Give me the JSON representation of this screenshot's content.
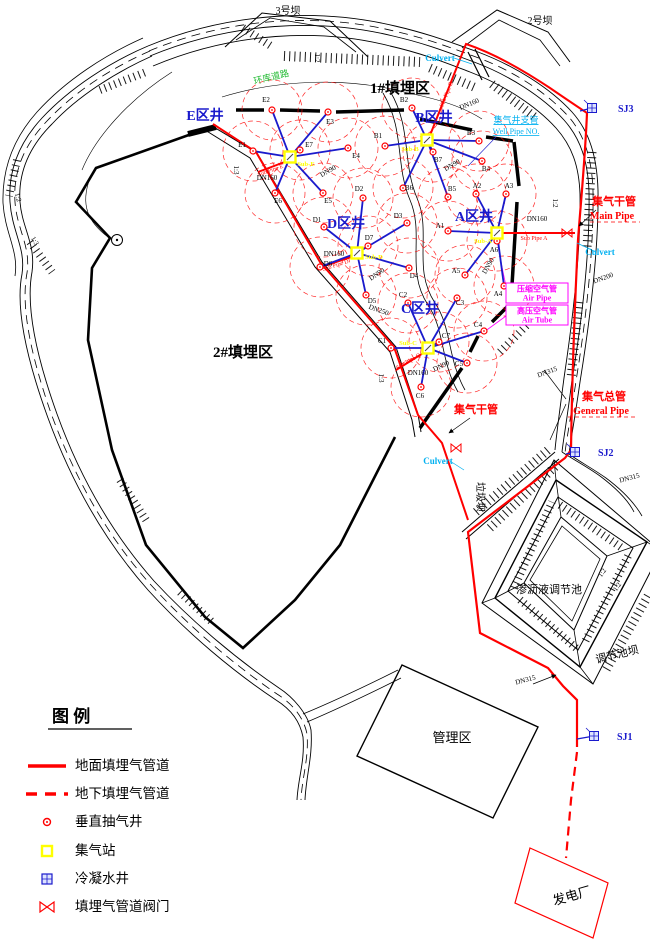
{
  "colors": {
    "pipe_red": "#ff0000",
    "spoke_blue": "#1a1acc",
    "cyan": "#00b0f0",
    "magenta": "#ff00ff",
    "yellow": "#ffff00",
    "green": "#22bb33",
    "black": "#000000"
  },
  "legend": {
    "title": "图   例",
    "items": [
      {
        "symbol": "solid-line",
        "label": "地面填埋气管道"
      },
      {
        "symbol": "dashed-line",
        "label": "地下填埋气管道"
      },
      {
        "symbol": "well-circle",
        "label": "垂直抽气井"
      },
      {
        "symbol": "station-square",
        "label": "集气站"
      },
      {
        "symbol": "condensate-square",
        "label": "冷凝水井"
      },
      {
        "symbol": "valve-bowtie",
        "label": "填埋气管道阀门"
      }
    ]
  },
  "clusters": [
    {
      "id": "E",
      "label": "E区井",
      "label_x": 205,
      "label_y": 120,
      "station_x": 290,
      "station_y": 157,
      "station_label": "Sub-E",
      "station_label_x": 306,
      "station_label_y": 166,
      "wells": [
        {
          "id": "E1",
          "x": 253,
          "y": 151,
          "lx": 242,
          "ly": 147
        },
        {
          "id": "E2",
          "x": 272,
          "y": 110,
          "lx": 266,
          "ly": 102
        },
        {
          "id": "E3",
          "x": 328,
          "y": 112,
          "lx": 330,
          "ly": 124
        },
        {
          "id": "E4",
          "x": 348,
          "y": 148,
          "lx": 356,
          "ly": 158
        },
        {
          "id": "E5",
          "x": 323,
          "y": 193,
          "lx": 328,
          "ly": 203
        },
        {
          "id": "E6",
          "x": 275,
          "y": 193,
          "lx": 278,
          "ly": 203
        },
        {
          "id": "E7",
          "x": 300,
          "y": 150,
          "lx": 309,
          "ly": 147
        }
      ]
    },
    {
      "id": "B",
      "label": "B区井",
      "label_x": 434,
      "label_y": 122,
      "station_x": 427,
      "station_y": 140,
      "station_label": "Sub-B",
      "station_label_x": 410,
      "station_label_y": 151,
      "wells": [
        {
          "id": "B1",
          "x": 385,
          "y": 146,
          "lx": 378,
          "ly": 138
        },
        {
          "id": "B2",
          "x": 412,
          "y": 108,
          "lx": 404,
          "ly": 102
        },
        {
          "id": "B3",
          "x": 479,
          "y": 141,
          "lx": 471,
          "ly": 135
        },
        {
          "id": "B4",
          "x": 482,
          "y": 161,
          "lx": 486,
          "ly": 171
        },
        {
          "id": "B5",
          "x": 448,
          "y": 197,
          "lx": 452,
          "ly": 191
        },
        {
          "id": "B6",
          "x": 403,
          "y": 188,
          "lx": 409,
          "ly": 190
        },
        {
          "id": "B7",
          "x": 433,
          "y": 152,
          "lx": 438,
          "ly": 162
        }
      ]
    },
    {
      "id": "A",
      "label": "A区井",
      "label_x": 474,
      "label_y": 221,
      "station_x": 497,
      "station_y": 233,
      "station_label": "Sub-A",
      "station_label_x": 483,
      "station_label_y": 243,
      "wells": [
        {
          "id": "A1",
          "x": 448,
          "y": 231,
          "lx": 440,
          "ly": 228
        },
        {
          "id": "A2",
          "x": 476,
          "y": 194,
          "lx": 477,
          "ly": 188
        },
        {
          "id": "A3",
          "x": 506,
          "y": 194,
          "lx": 509,
          "ly": 188
        },
        {
          "id": "A4",
          "x": 504,
          "y": 286,
          "lx": 498,
          "ly": 296
        },
        {
          "id": "A5",
          "x": 465,
          "y": 275,
          "lx": 456,
          "ly": 273
        },
        {
          "id": "A6",
          "x": 497,
          "y": 241,
          "lx": 494,
          "ly": 252
        }
      ]
    },
    {
      "id": "D",
      "label": "D区井",
      "label_x": 346,
      "label_y": 228,
      "station_x": 357,
      "station_y": 253,
      "station_label": "Sub-D",
      "station_label_x": 374,
      "station_label_y": 259,
      "wells": [
        {
          "id": "D1",
          "x": 324,
          "y": 227,
          "lx": 317,
          "ly": 222
        },
        {
          "id": "D2",
          "x": 363,
          "y": 198,
          "lx": 359,
          "ly": 191
        },
        {
          "id": "D3",
          "x": 407,
          "y": 223,
          "lx": 398,
          "ly": 218
        },
        {
          "id": "D4",
          "x": 409,
          "y": 268,
          "lx": 414,
          "ly": 278
        },
        {
          "id": "D5",
          "x": 366,
          "y": 295,
          "lx": 372,
          "ly": 303
        },
        {
          "id": "D6",
          "x": 320,
          "y": 267,
          "lx": 328,
          "ly": 266
        },
        {
          "id": "D7",
          "x": 368,
          "y": 246,
          "lx": 369,
          "ly": 240
        }
      ]
    },
    {
      "id": "C",
      "label": "C区井",
      "label_x": 420,
      "label_y": 313,
      "station_x": 428,
      "station_y": 348,
      "station_label": "Sub-C",
      "station_label_x": 408,
      "station_label_y": 345,
      "wells": [
        {
          "id": "C1",
          "x": 391,
          "y": 348,
          "lx": 382,
          "ly": 343
        },
        {
          "id": "C2",
          "x": 408,
          "y": 303,
          "lx": 403,
          "ly": 297
        },
        {
          "id": "C3",
          "x": 457,
          "y": 298,
          "lx": 460,
          "ly": 305
        },
        {
          "id": "C4",
          "x": 484,
          "y": 331,
          "lx": 478,
          "ly": 327
        },
        {
          "id": "C5",
          "x": 467,
          "y": 363,
          "lx": 459,
          "ly": 366
        },
        {
          "id": "C6",
          "x": 421,
          "y": 387,
          "lx": 420,
          "ly": 398
        },
        {
          "id": "C7",
          "x": 439,
          "y": 342,
          "lx": 446,
          "ly": 338
        }
      ]
    }
  ],
  "sj_stations": [
    {
      "id": "SJ3",
      "x": 592,
      "y": 108,
      "tx": 612,
      "ty": 112,
      "stub_x": 580,
      "stub_y": 111
    },
    {
      "id": "SJ2",
      "x": 575,
      "y": 452,
      "tx": 592,
      "ty": 456,
      "stub_x": 566,
      "stub_y": 454
    },
    {
      "id": "SJ1",
      "x": 594,
      "y": 736,
      "tx": 611,
      "ty": 740,
      "stub_x": 577,
      "stub_y": 739
    }
  ],
  "air_boxes": [
    {
      "cn": "压缩空气管",
      "en": "Air Pipe",
      "x": 506,
      "y": 283,
      "w": 62,
      "h": 20
    },
    {
      "cn": "高压空气管",
      "en": "Air Tube",
      "x": 506,
      "y": 305,
      "w": 62,
      "h": 20
    }
  ],
  "labels": [
    {
      "name": "landfill1-label",
      "text": "1#填埋区",
      "x": 400,
      "y": 93,
      "size": 15,
      "bold": true
    },
    {
      "name": "landfill2-label",
      "text": "2#填埋区",
      "x": 243,
      "y": 357,
      "size": 15,
      "bold": true
    },
    {
      "name": "management-label",
      "text": "管理区",
      "x": 452,
      "y": 742,
      "size": 13
    },
    {
      "name": "power-plant-label",
      "text": "发电厂",
      "x": 573,
      "y": 900,
      "size": 13,
      "rot": -16
    },
    {
      "name": "pond-label",
      "text": "渗沥液调节池",
      "x": 549,
      "y": 593,
      "size": 11
    },
    {
      "name": "pond-dam-label",
      "text": "调节池坝",
      "x": 618,
      "y": 658,
      "size": 11,
      "rot": -14
    },
    {
      "name": "garbage-dam-label",
      "text": "垃圾坝",
      "x": 477,
      "y": 497,
      "size": 10,
      "rot": 90
    },
    {
      "name": "dam3-label",
      "text": "3号坝",
      "x": 288,
      "y": 14,
      "size": 10
    },
    {
      "name": "dam2-label",
      "text": "2号坝",
      "x": 540,
      "y": 24,
      "size": 10
    },
    {
      "name": "ring-road-label",
      "text": "环库道路",
      "x": 272,
      "y": 80,
      "size": 9,
      "color": "#22bb33",
      "rot": -14
    },
    {
      "name": "main-pipe-label-cn",
      "text": "集气干管",
      "x": 614,
      "y": 205,
      "size": 11,
      "color": "#ff0000",
      "bold": true
    },
    {
      "name": "main-pipe-label-en",
      "text": "Main Pipe",
      "x": 612,
      "y": 219,
      "size": 10,
      "color": "#ff0000",
      "bold": true
    },
    {
      "name": "main-pipe2-label-cn",
      "text": "集气干管",
      "x": 476,
      "y": 413,
      "size": 11,
      "color": "#ff0000",
      "bold": true
    },
    {
      "name": "general-pipe-label-cn",
      "text": "集气总管",
      "x": 604,
      "y": 400,
      "size": 11,
      "color": "#ff0000",
      "bold": true
    },
    {
      "name": "general-pipe-label-en",
      "text": "General Pipe",
      "x": 601,
      "y": 414,
      "size": 10,
      "color": "#ff0000",
      "bold": true
    },
    {
      "name": "well-pipe-label-cn",
      "text": "集气井支管",
      "x": 516,
      "y": 123,
      "size": 9,
      "color": "#00b0f0",
      "underline": true
    },
    {
      "name": "well-pipe-label-en",
      "text": "Well Pipe NO.",
      "x": 516,
      "y": 134,
      "size": 8,
      "color": "#00b0f0",
      "underline": true
    },
    {
      "name": "culvert-label-1",
      "text": "Culvert",
      "x": 440,
      "y": 61,
      "size": 9,
      "color": "#00b0f0",
      "bold": true
    },
    {
      "name": "culvert-label-2",
      "text": "Culvert",
      "x": 600,
      "y": 255,
      "size": 9,
      "color": "#00b0f0",
      "bold": true
    },
    {
      "name": "culvert-label-3",
      "text": "Culvert",
      "x": 438,
      "y": 464,
      "size": 9,
      "color": "#00b0f0",
      "bold": true
    },
    {
      "name": "sub-pipe-e-label",
      "text": "Sub Pipe E",
      "x": 271,
      "y": 172,
      "size": 6,
      "color": "#ff0000",
      "rot": -20
    },
    {
      "name": "sub-pipe-b-label",
      "text": "Sub Pipe B",
      "x": 448,
      "y": 95,
      "size": 6,
      "color": "#ff0000",
      "rot": -68
    },
    {
      "name": "sub-pipe-a-label",
      "text": "Sub Pipe A",
      "x": 534,
      "y": 240,
      "size": 6,
      "color": "#ff0000"
    },
    {
      "name": "sub-pipe-d-label",
      "text": "Sub Pipe D",
      "x": 336,
      "y": 267,
      "size": 6,
      "color": "#ff0000",
      "rot": -18
    },
    {
      "name": "sub-pipe-c-label",
      "text": "Sub Pipe C",
      "x": 409,
      "y": 363,
      "size": 6,
      "color": "#ff0000",
      "rot": -30
    },
    {
      "name": "dn-label-e160",
      "text": "DN160",
      "x": 267,
      "y": 180,
      "size": 7
    },
    {
      "name": "dn-label-e90",
      "text": "DN90",
      "x": 329,
      "y": 173,
      "size": 7,
      "rot": -30
    },
    {
      "name": "dn-label-b160",
      "text": "DN160",
      "x": 470,
      "y": 106,
      "size": 7,
      "rot": -22
    },
    {
      "name": "dn-label-b90",
      "text": "DN90",
      "x": 453,
      "y": 167,
      "size": 7,
      "rot": -30
    },
    {
      "name": "dn-label-a160",
      "text": "DN160",
      "x": 537,
      "y": 221,
      "size": 7
    },
    {
      "name": "dn-label-a90",
      "text": "DN90",
      "x": 490,
      "y": 267,
      "size": 7,
      "rot": -60
    },
    {
      "name": "dn-label-d160",
      "text": "DN160",
      "x": 334,
      "y": 256,
      "size": 7
    },
    {
      "name": "dn-label-d90",
      "text": "DN90",
      "x": 378,
      "y": 276,
      "size": 7,
      "rot": -35
    },
    {
      "name": "dn-label-d250",
      "text": "DN250",
      "x": 378,
      "y": 312,
      "size": 7,
      "rot": 20
    },
    {
      "name": "dn-label-c160",
      "text": "DN160",
      "x": 418,
      "y": 375,
      "size": 7
    },
    {
      "name": "dn-label-c90",
      "text": "DN90",
      "x": 442,
      "y": 368,
      "size": 7,
      "rot": -25
    },
    {
      "name": "dn-label-200",
      "text": "DN200",
      "x": 604,
      "y": 280,
      "size": 7,
      "rot": -20
    },
    {
      "name": "dn-label-315a",
      "text": "DN315",
      "x": 630,
      "y": 480,
      "size": 7,
      "rot": -15
    },
    {
      "name": "dn-label-315b",
      "text": "DN315",
      "x": 548,
      "y": 374,
      "size": 7,
      "rot": -20
    },
    {
      "name": "dn-label-315c",
      "text": "DN315",
      "x": 526,
      "y": 682,
      "size": 7,
      "rot": -15
    },
    {
      "name": "slope-label-1",
      "text": "1:2",
      "x": 315,
      "y": 58,
      "size": 7,
      "rot": 90
    },
    {
      "name": "slope-label-2",
      "text": "1:3",
      "x": 234,
      "y": 170,
      "size": 7,
      "rot": 90
    },
    {
      "name": "slope-label-3",
      "text": "1:2",
      "x": 16,
      "y": 198,
      "size": 7,
      "rot": 75
    },
    {
      "name": "slope-label-4",
      "text": "1:3",
      "x": 33,
      "y": 242,
      "size": 7,
      "rot": 60
    },
    {
      "name": "slope-label-5",
      "text": "1:2",
      "x": 553,
      "y": 203,
      "size": 7,
      "rot": 90
    },
    {
      "name": "slope-label-6",
      "text": "1:3",
      "x": 379,
      "y": 378,
      "size": 7,
      "rot": 90
    },
    {
      "name": "slope-label-7",
      "text": "1:2",
      "x": 604,
      "y": 574,
      "size": 7,
      "rot": -55
    },
    {
      "name": "slope-label-8",
      "text": "1:2",
      "x": 619,
      "y": 588,
      "size": 7,
      "rot": -55
    }
  ]
}
